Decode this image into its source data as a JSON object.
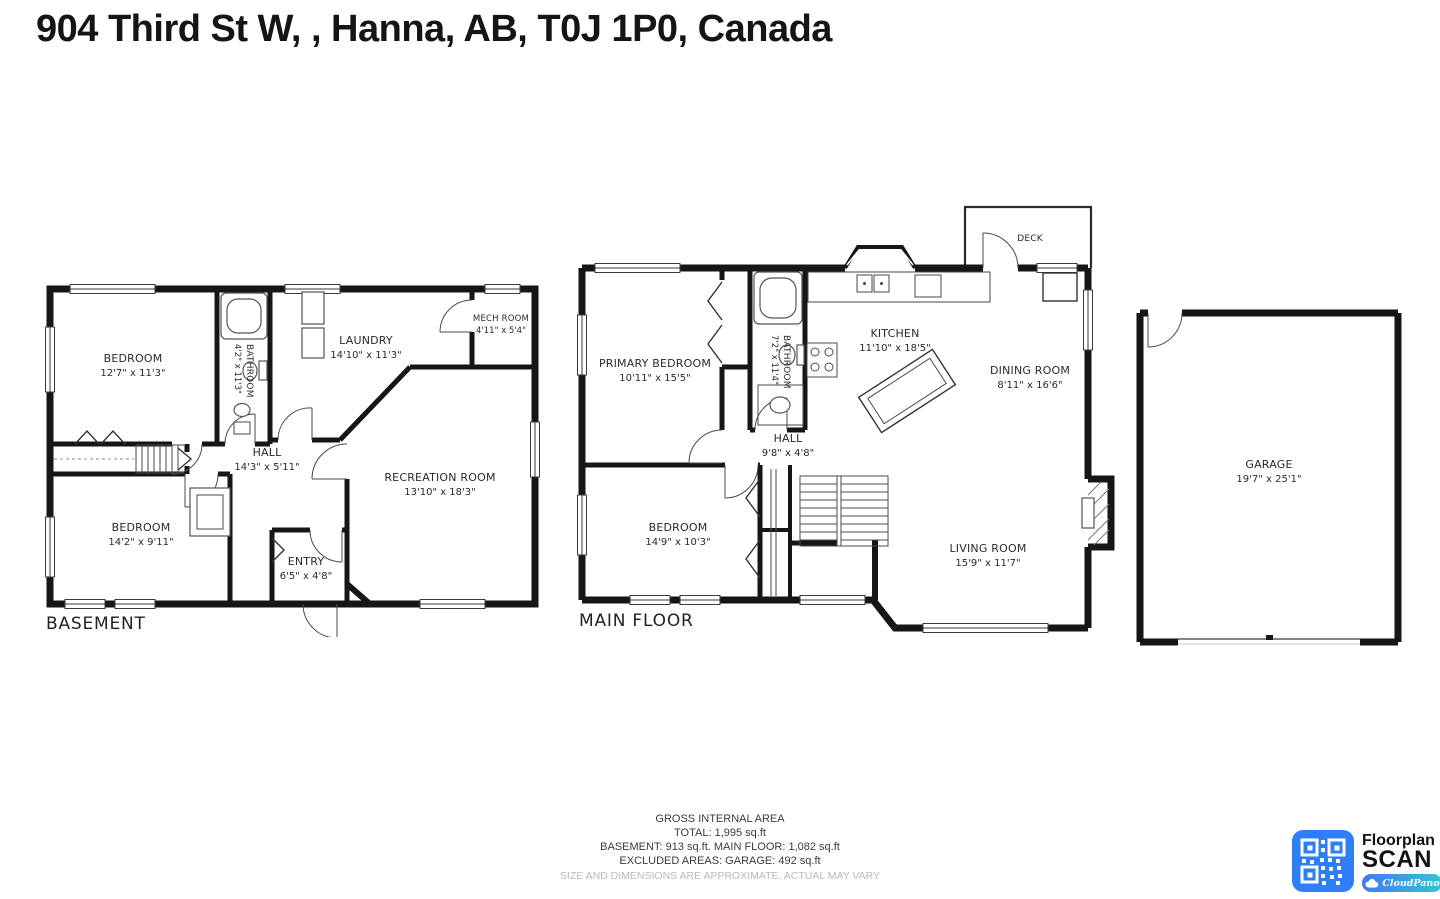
{
  "title": "904 Third St W, , Hanna, AB, T0J 1P0, Canada",
  "plans": {
    "basement": {
      "label": "BASEMENT",
      "rooms": {
        "bedroom1": {
          "name": "BEDROOM",
          "dims": "12'7\" x 11'3\""
        },
        "bathroom": {
          "name": "BATHROOM",
          "dims": "4'2\" x 11'3\""
        },
        "laundry": {
          "name": "LAUNDRY",
          "dims": "14'10\" x 11'3\""
        },
        "mech": {
          "name": "MECH ROOM",
          "dims": "4'11\" x 5'4\""
        },
        "hall": {
          "name": "HALL",
          "dims": "14'3\" x 5'11\""
        },
        "recreation": {
          "name": "RECREATION ROOM",
          "dims": "13'10\" x 18'3\""
        },
        "bedroom2": {
          "name": "BEDROOM",
          "dims": "14'2\" x 9'11\""
        },
        "entry": {
          "name": "ENTRY",
          "dims": "6'5\" x 4'8\""
        }
      }
    },
    "main": {
      "label": "MAIN FLOOR",
      "rooms": {
        "deck": {
          "name": "DECK",
          "dims": ""
        },
        "primary": {
          "name": "PRIMARY BEDROOM",
          "dims": "10'11\" x 15'5\""
        },
        "bathroom": {
          "name": "BATHROOM",
          "dims": "7'2\" x 11'4\""
        },
        "kitchen": {
          "name": "KITCHEN",
          "dims": "11'10\" x 18'5\""
        },
        "dining": {
          "name": "DINING ROOM",
          "dims": "8'11\" x 16'6\""
        },
        "hall": {
          "name": "HALL",
          "dims": "9'8\" x 4'8\""
        },
        "bedroom": {
          "name": "BEDROOM",
          "dims": "14'9\" x 10'3\""
        },
        "living": {
          "name": "LIVING ROOM",
          "dims": "15'9\" x 11'7\""
        }
      }
    },
    "garage": {
      "rooms": {
        "garage": {
          "name": "GARAGE",
          "dims": "19'7\" x 25'1\""
        }
      }
    }
  },
  "footer": {
    "line1": "GROSS INTERNAL AREA",
    "line2": "TOTAL: 1,995 sq.ft",
    "line3": "BASEMENT: 913 sq.ft. MAIN FLOOR: 1,082 sq.ft",
    "line4": "EXCLUDED AREAS: GARAGE: 492 sq.ft",
    "disclaimer": "SIZE AND DIMENSIONS ARE APPROXIMATE, ACTUAL MAY VARY"
  },
  "logo": {
    "brand_top": "Floorplan",
    "brand_bottom": "SCAN",
    "badge": "CloudPano",
    "qr_color": "#2e7ef7",
    "badge_gradient_start": "#4478f2",
    "badge_gradient_end": "#2fc8d6"
  }
}
